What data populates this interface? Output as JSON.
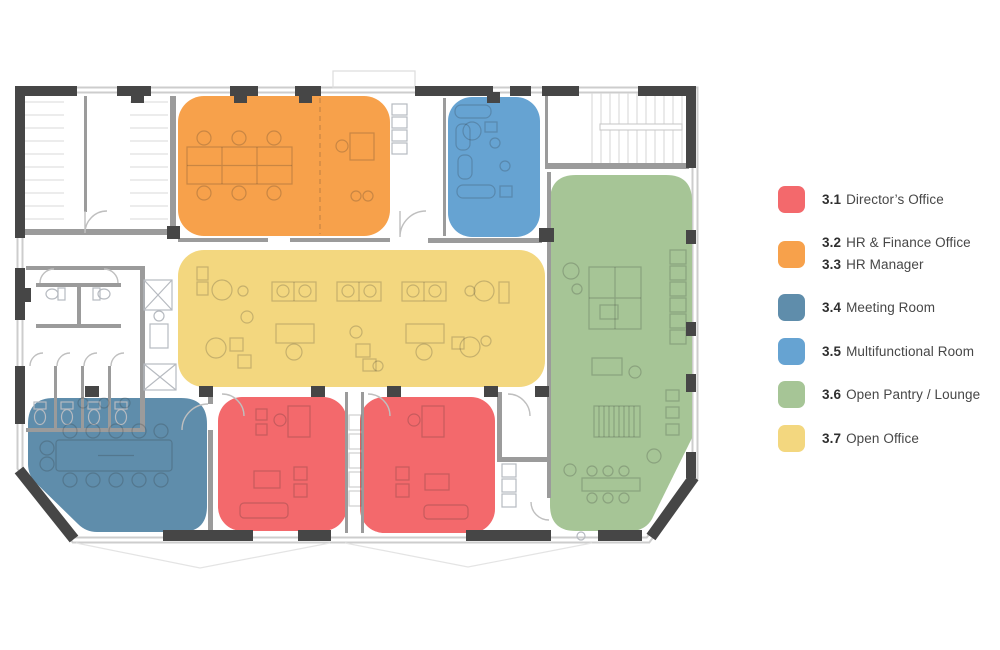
{
  "colors": {
    "director_red": "#f3696c",
    "hr_orange": "#f7a14b",
    "meeting_blue": "#5f8dab",
    "multifunctional_blue": "#66a3d2",
    "pantry_green": "#a6c596",
    "office_yellow": "#f3d77f",
    "wall_dark": "#464646",
    "wall_gray": "#9b9b9b",
    "background": "#ffffff"
  },
  "legend": {
    "items": [
      {
        "key": "directors-office",
        "lines": [
          {
            "num": "3.1",
            "label": "Director’s Office"
          }
        ]
      },
      {
        "key": "hr-finance",
        "lines": [
          {
            "num": "3.2",
            "label": "HR & Finance Office"
          },
          {
            "num": "3.3",
            "label": "HR Manager"
          }
        ]
      },
      {
        "key": "meeting-room",
        "lines": [
          {
            "num": "3.4",
            "label": "Meeting Room"
          }
        ]
      },
      {
        "key": "multifunctional-room",
        "lines": [
          {
            "num": "3.5",
            "label": "Multifunctional Room"
          }
        ]
      },
      {
        "key": "open-pantry-lounge",
        "lines": [
          {
            "num": "3.6",
            "label": "Open Pantry / Lounge"
          }
        ]
      },
      {
        "key": "open-office",
        "lines": [
          {
            "num": "3.7",
            "label": "Open Office"
          }
        ]
      }
    ]
  }
}
